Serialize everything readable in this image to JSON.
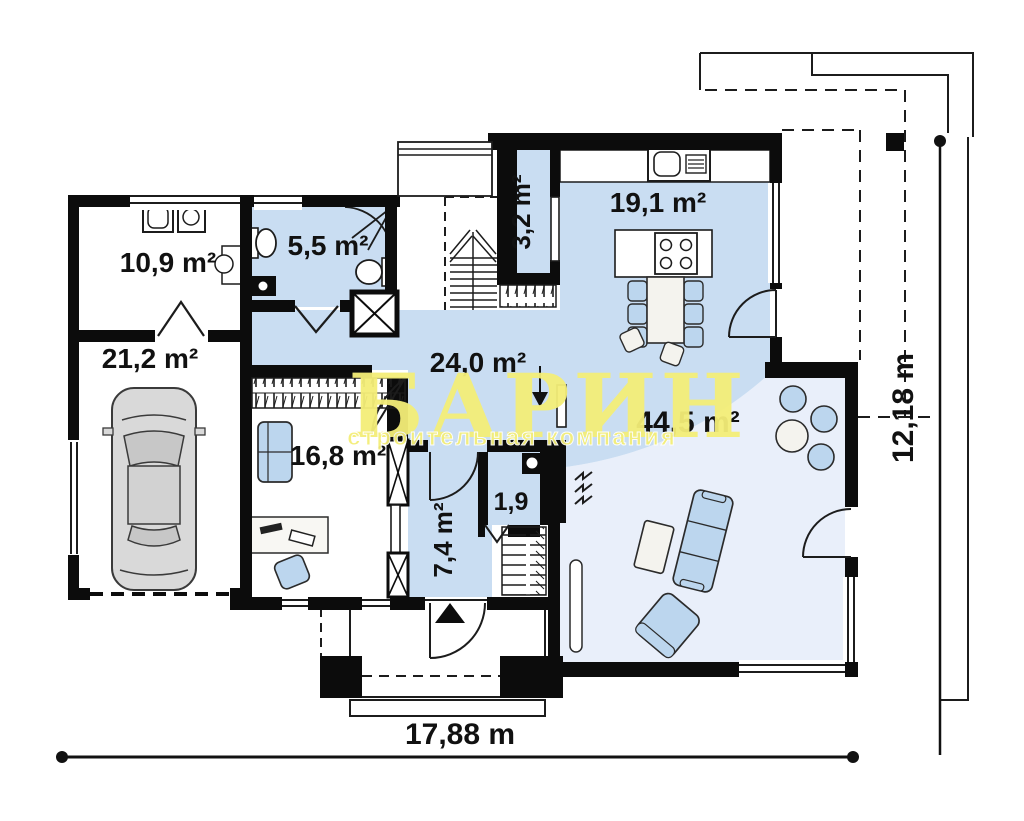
{
  "plan": {
    "watermark": {
      "title": "БАРИН",
      "subtitle": "строительная компания"
    },
    "rooms": [
      {
        "name": "utility",
        "area": "10,9 m²"
      },
      {
        "name": "bathroom",
        "area": "5,5 m²"
      },
      {
        "name": "garage",
        "area": "21,2 m²"
      },
      {
        "name": "cabinet",
        "area": "16,8 m²"
      },
      {
        "name": "hall",
        "area": "24,0 m²"
      },
      {
        "name": "pantry",
        "area": "3,2 m²"
      },
      {
        "name": "kitchen",
        "area": "19,1 m²"
      },
      {
        "name": "living-room",
        "area": "44,5 m²"
      },
      {
        "name": "vestibule",
        "area": "7,4 m²"
      },
      {
        "name": "wc",
        "area": "1,9"
      }
    ],
    "dimensions": {
      "width": "17,88 m",
      "height": "12,18 m"
    },
    "colors": {
      "room_blue": "#c9ddf2",
      "living_blue": "#e9effa",
      "furniture_blue": "#bcd6ee",
      "wall_black": "#0c0c0c",
      "watermark_yellow": "#f4ee78"
    }
  }
}
